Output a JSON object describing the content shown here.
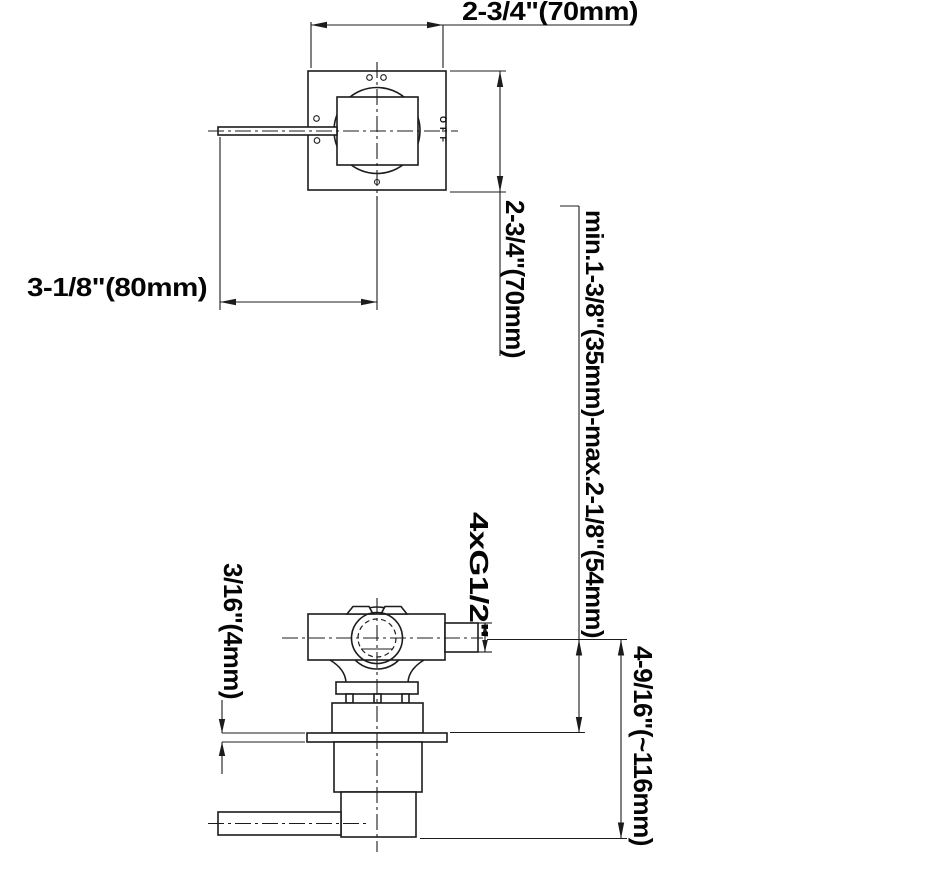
{
  "drawing": {
    "title": "concealed-shower-valve-dimension-drawing",
    "background": "#ffffff",
    "line_color": "#1c1c1c",
    "dimensions": {
      "plate_width": "2-3/4\"(70mm)",
      "plate_height": "2-3/4\"(70mm)",
      "handle_projection": "3-1/8\"(80mm)",
      "install_depth_range": "min.1-3/8\"(35mm)-max.2-1/8\"(54mm)",
      "port_spec": "4xG1/2\"",
      "plate_thickness": "3/16\"(4mm)",
      "overall_height": "4-9/16\"(~116mm)"
    },
    "markings": {
      "handle_label": "OFF"
    }
  }
}
